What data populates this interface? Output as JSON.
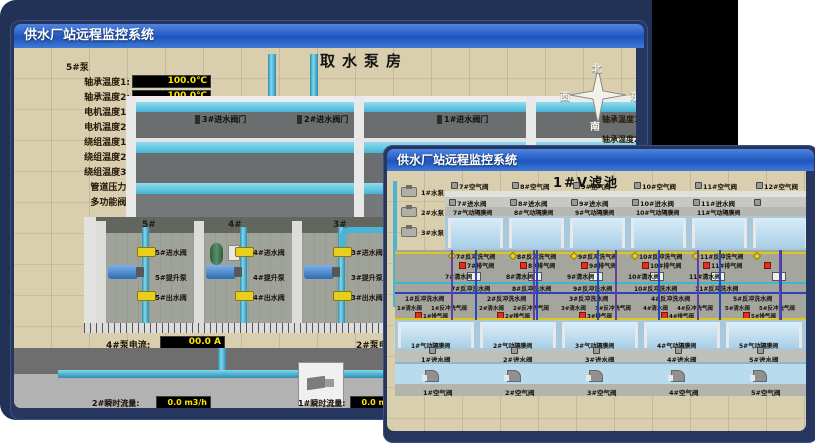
{
  "colors": {
    "background_navy": "#223256",
    "titlebar_blue": "#1e55be",
    "value_yellow": "#ffe400",
    "alarm_red": "#e03020",
    "pipe_cyan": "#49b4d4",
    "valve_yellow": "#e6cf1e",
    "pool_blue": "#cfe6f4",
    "ground_tan": "#d9cead"
  },
  "back_window": {
    "title": "供水厂站远程监控系统",
    "scene_title": "取水泵房",
    "pump_panel": {
      "header": "5#泵",
      "readouts": [
        {
          "label": "轴承温度1:",
          "value": "100.0℃"
        },
        {
          "label": "轴承温度2:",
          "value": "100.0℃"
        },
        {
          "label": "电机温度1:",
          "value": "18.1℃"
        },
        {
          "label": "电机温度2:",
          "value": "17.9℃"
        },
        {
          "label": "绕组温度1:",
          "value": "18.0℃"
        },
        {
          "label": "绕组温度2:",
          "value": "18.1℃"
        },
        {
          "label": "绕组温度3:",
          "value": "18.1℃"
        },
        {
          "label": "管道压力:",
          "value": "0.0007MPa"
        },
        {
          "label": "多功能阀:",
          "value": "0%"
        }
      ]
    },
    "inlet_valve_labels": [
      {
        "label": "3#进水阀门"
      },
      {
        "label": "2#进水阀门"
      },
      {
        "label": "1#进水阀门"
      }
    ],
    "compass": {
      "north": "北",
      "south": "南",
      "west": "西",
      "east": "东"
    },
    "right_labels": [
      {
        "label": "轴承温度1:"
      },
      {
        "label": "轴承温度2:"
      }
    ],
    "bays": [
      {
        "num": "5#",
        "inlet": "5#进水阀",
        "pump": "5#提升泵",
        "outlet": "5#出水阀"
      },
      {
        "num": "4#",
        "inlet": "4#进水阀",
        "pump": "4#提升泵",
        "outlet": "4#出水阀"
      },
      {
        "num": "3#",
        "inlet": "3#进水阀",
        "pump": "3#提升泵",
        "outlet": "3#出水阀"
      }
    ],
    "current_left": {
      "label": "4#泵电流:",
      "value": "00.0 A"
    },
    "current_right": {
      "label": "2#泵电流:"
    },
    "flow_left": {
      "label": "2#瞬时流量:",
      "value": "0.0 m3/h"
    },
    "flow_right": {
      "label": "1#瞬时流量:",
      "value": "0.0 m3/h"
    }
  },
  "front_window": {
    "title": "供水厂站远程监控系统",
    "scene_title": "1#V滤池",
    "pumps": [
      {
        "label": "1#水泵"
      },
      {
        "label": "2#水泵"
      },
      {
        "label": "3#水泵"
      }
    ],
    "blowers": [
      {
        "label": "1#风机"
      },
      {
        "label": "2#风机"
      },
      {
        "label": "3#风机"
      }
    ],
    "top_cells": [
      {
        "air": "7#空气阀",
        "inlet": "7#进水阀",
        "diaphragm": "7#气动隔膜阀",
        "bw_air": "7#反冲洗气阀",
        "exhaust": "7#排气阀",
        "clean": "7#清水阀",
        "bw_water": "7#反冲洗水阀"
      },
      {
        "air": "8#空气阀",
        "inlet": "8#进水阀",
        "diaphragm": "8#气动隔膜阀",
        "bw_air": "8#反冲洗气阀",
        "exhaust": "8#排气阀",
        "clean": "8#清水阀",
        "bw_water": "8#反冲洗水阀"
      },
      {
        "air": "9#空气阀",
        "inlet": "9#进水阀",
        "diaphragm": "9#气动隔膜阀",
        "bw_air": "9#反冲洗气阀",
        "exhaust": "9#排气阀",
        "clean": "9#清水阀",
        "bw_water": "9#反冲洗水阀"
      },
      {
        "air": "10#空气阀",
        "inlet": "10#进水阀",
        "diaphragm": "10#气动隔膜阀",
        "bw_air": "10#反冲洗气阀",
        "exhaust": "10#排气阀",
        "clean": "10#清水阀",
        "bw_water": "10#反冲洗水阀"
      },
      {
        "air": "11#空气阀",
        "inlet": "11#进水阀",
        "diaphragm": "11#气动隔膜阀",
        "bw_air": "11#反冲洗气阀",
        "exhaust": "11#排气阀",
        "clean": "11#清水阀",
        "bw_water": "11#反冲洗水阀"
      },
      {
        "air": "12#空气阀"
      }
    ],
    "bottom_cells": [
      {
        "bw_water": "1#反冲洗水阀",
        "clean": "1#清水阀",
        "bw_air": "1#反冲洗气阀",
        "exhaust": "1#排气阀",
        "diaphragm": "1#气动隔膜阀",
        "inlet": "1#进水阀",
        "air": "1#空气阀"
      },
      {
        "bw_water": "2#反冲洗水阀",
        "clean": "2#清水阀",
        "bw_air": "2#反冲洗气阀",
        "exhaust": "2#排气阀",
        "diaphragm": "2#气动隔膜阀",
        "inlet": "2#进水阀",
        "air": "2#空气阀"
      },
      {
        "bw_water": "3#反冲洗水阀",
        "clean": "3#清水阀",
        "bw_air": "3#反冲洗气阀",
        "exhaust": "3#排气阀",
        "diaphragm": "3#气动隔膜阀",
        "inlet": "3#进水阀",
        "air": "3#空气阀"
      },
      {
        "bw_water": "4#反冲洗水阀",
        "clean": "4#清水阀",
        "bw_air": "4#反冲洗气阀",
        "exhaust": "4#排气阀",
        "diaphragm": "4#气动隔膜阀",
        "inlet": "4#进水阀",
        "air": "4#空气阀"
      },
      {
        "bw_water": "5#反冲洗水阀",
        "clean": "5#清水阀",
        "bw_air": "5#反冲洗气阀",
        "exhaust": "5#排气阀",
        "diaphragm": "5#气动隔膜阀",
        "inlet": "5#进水阀",
        "air": "5#空气阀"
      }
    ]
  }
}
